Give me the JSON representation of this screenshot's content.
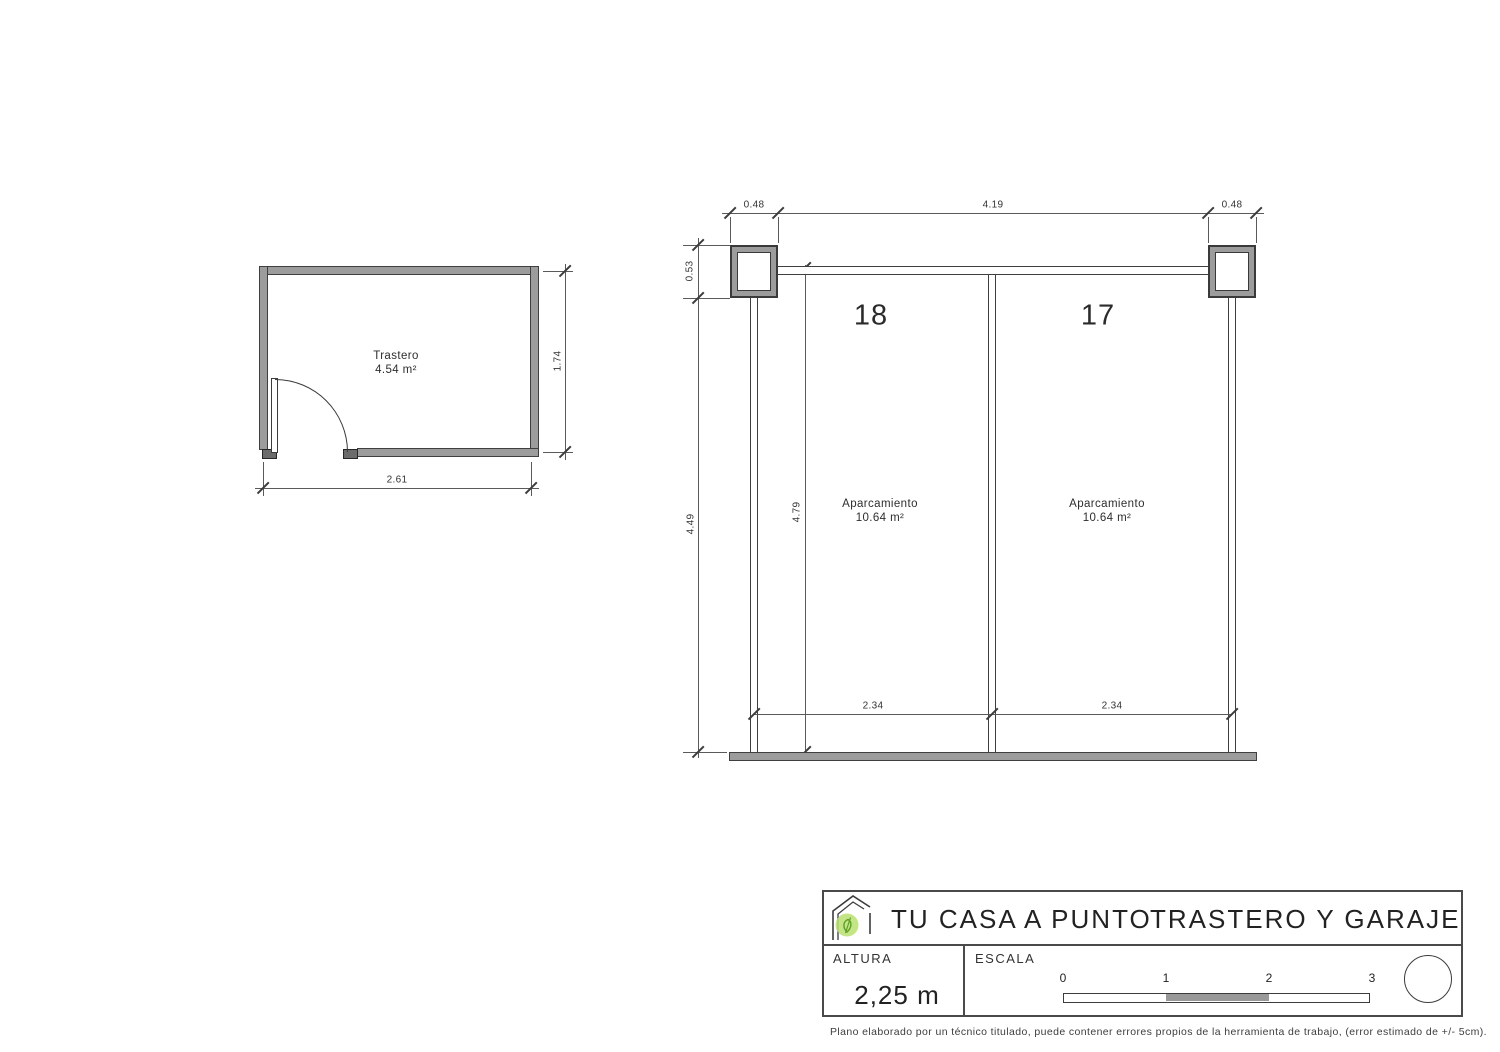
{
  "colors": {
    "line": "#4a4a4a",
    "wall_fill": "#9c9c9c",
    "logo_green": "#b9e070",
    "scale_bar_mid": "#999999"
  },
  "trastero": {
    "name": "Trastero",
    "area": "4.54 m²",
    "width_dim": "2.61",
    "height_dim": "1.74"
  },
  "garage": {
    "dims": {
      "top_left": "0.48",
      "top_center": "4.19",
      "top_right": "0.48",
      "left_upper": "0.53",
      "left_full": "4.49",
      "inner_height": "4.79"
    },
    "spaces": [
      {
        "number": "18",
        "label": "Aparcamiento",
        "area": "10.64 m²",
        "width_dim": "2.34"
      },
      {
        "number": "17",
        "label": "Aparcamiento",
        "area": "10.64 m²",
        "width_dim": "2.34"
      }
    ]
  },
  "title_block": {
    "company": "TU CASA A PUNTO",
    "sheet_title": "TRASTERO Y GARAJE",
    "altura_label": "ALTURA",
    "altura_value": "2,25 m",
    "escala_label": "ESCALA",
    "scale_ticks": [
      "0",
      "1",
      "2",
      "3"
    ],
    "disclaimer": "Plano elaborado por un técnico titulado, puede contener errores propios de la herramienta de trabajo, (error estimado de +/- 5cm)."
  }
}
